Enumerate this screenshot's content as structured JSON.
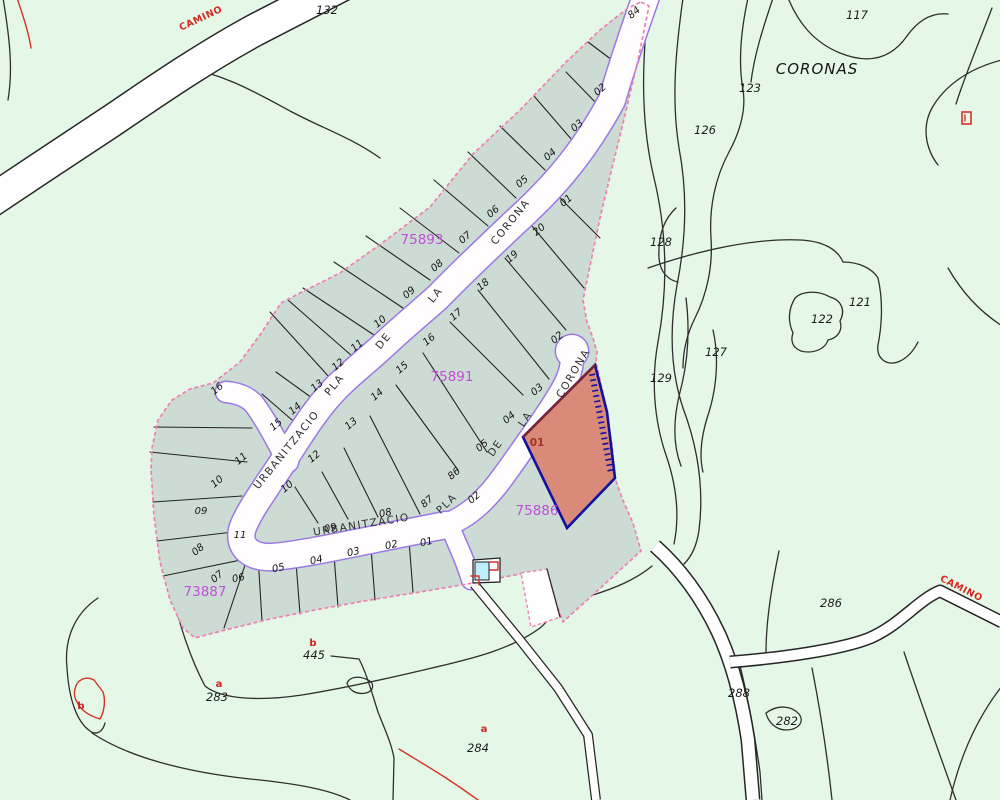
{
  "title": "Cadastral map - Urbanitzacio Pla de la Corona",
  "region_name": "CORONAS",
  "highlighted_plot": {
    "number": "01",
    "parcel_id": "75886"
  },
  "parcel_ids": [
    "75893",
    "75891",
    "75886",
    "73887"
  ],
  "colors": {
    "background": "#e5f7e6",
    "urbanization_fill": "#ccdbd3",
    "road_fill": "#fffdfd",
    "road_border": "#9a79e6",
    "boundary_dash": "#f07fb4",
    "contour": "#2e2e2e",
    "highlight_fill": "#d98a79",
    "highlight_border": "#10129e",
    "highlight_top_edge": "#7c2230",
    "magenta_label": "#c24fd8",
    "red_label": "#cf2020"
  },
  "labels": [
    {
      "t": "CAMINO",
      "x": 202,
      "y": 21,
      "r": -25,
      "c": "camino",
      "n": "road-name-camino-topleft"
    },
    {
      "t": "CAMINO",
      "x": 960,
      "y": 591,
      "r": 27,
      "c": "camino",
      "n": "road-name-camino-right"
    },
    {
      "t": "CORONAS",
      "x": 817,
      "y": 74,
      "r": 0,
      "c": "coronas",
      "n": "region-name-coronas"
    },
    {
      "t": "132",
      "x": 327,
      "y": 14,
      "r": 0,
      "c": "tn",
      "n": "terrain-number"
    },
    {
      "t": "117",
      "x": 857,
      "y": 19,
      "r": 0,
      "c": "tn",
      "n": "terrain-number"
    },
    {
      "t": "123",
      "x": 750,
      "y": 92,
      "r": 0,
      "c": "tn",
      "n": "terrain-number"
    },
    {
      "t": "126",
      "x": 705,
      "y": 134,
      "r": 0,
      "c": "tn",
      "n": "terrain-number"
    },
    {
      "t": "128",
      "x": 661,
      "y": 246,
      "r": 0,
      "c": "tn",
      "n": "terrain-number"
    },
    {
      "t": "121",
      "x": 860,
      "y": 306,
      "r": 0,
      "c": "tn",
      "n": "terrain-number"
    },
    {
      "t": "122",
      "x": 822,
      "y": 323,
      "r": 0,
      "c": "tn",
      "n": "terrain-number"
    },
    {
      "t": "127",
      "x": 716,
      "y": 356,
      "r": 0,
      "c": "tn",
      "n": "terrain-number"
    },
    {
      "t": "129",
      "x": 661,
      "y": 382,
      "r": 0,
      "c": "tn",
      "n": "terrain-number"
    },
    {
      "t": "286",
      "x": 831,
      "y": 607,
      "r": 0,
      "c": "tn",
      "n": "terrain-number"
    },
    {
      "t": "288",
      "x": 739,
      "y": 697,
      "r": 0,
      "c": "tn",
      "n": "terrain-number"
    },
    {
      "t": "282",
      "x": 787,
      "y": 725,
      "r": 0,
      "c": "tn",
      "n": "terrain-number"
    },
    {
      "t": "445",
      "x": 314,
      "y": 659,
      "r": 0,
      "c": "tn",
      "n": "terrain-number"
    },
    {
      "t": "283",
      "x": 217,
      "y": 701,
      "r": 0,
      "c": "tn",
      "n": "terrain-number"
    },
    {
      "t": "284",
      "x": 478,
      "y": 752,
      "r": 0,
      "c": "tn",
      "n": "terrain-number"
    },
    {
      "t": "75893",
      "x": 422,
      "y": 244,
      "r": 0,
      "c": "mg",
      "n": "parcel-id-75893"
    },
    {
      "t": "75891",
      "x": 452,
      "y": 381,
      "r": 0,
      "c": "mg",
      "n": "parcel-id-75891"
    },
    {
      "t": "75886",
      "x": 537,
      "y": 515,
      "r": 0,
      "c": "mg",
      "n": "parcel-id-75886"
    },
    {
      "t": "73887",
      "x": 205,
      "y": 596,
      "r": 0,
      "c": "mg",
      "n": "parcel-id-73887"
    },
    {
      "t": "84",
      "x": 636,
      "y": 15,
      "r": -40,
      "c": "pn",
      "n": "plot-number-84"
    },
    {
      "t": "02",
      "x": 602,
      "y": 92,
      "r": -40,
      "c": "pn",
      "n": "plot-number"
    },
    {
      "t": "03",
      "x": 579,
      "y": 128,
      "r": -40,
      "c": "pn",
      "n": "plot-number"
    },
    {
      "t": "04",
      "x": 552,
      "y": 157,
      "r": -40,
      "c": "pn",
      "n": "plot-number"
    },
    {
      "t": "05",
      "x": 524,
      "y": 184,
      "r": -40,
      "c": "pn",
      "n": "plot-number"
    },
    {
      "t": "06",
      "x": 495,
      "y": 214,
      "r": -40,
      "c": "pn",
      "n": "plot-number"
    },
    {
      "t": "07",
      "x": 467,
      "y": 240,
      "r": -40,
      "c": "pn",
      "n": "plot-number"
    },
    {
      "t": "08",
      "x": 439,
      "y": 268,
      "r": -40,
      "c": "pn",
      "n": "plot-number"
    },
    {
      "t": "09",
      "x": 411,
      "y": 295,
      "r": -40,
      "c": "pn",
      "n": "plot-number"
    },
    {
      "t": "10",
      "x": 382,
      "y": 324,
      "r": -40,
      "c": "pn",
      "n": "plot-number"
    },
    {
      "t": "11",
      "x": 359,
      "y": 348,
      "r": -40,
      "c": "pn",
      "n": "plot-number"
    },
    {
      "t": "12",
      "x": 340,
      "y": 367,
      "r": -40,
      "c": "pn",
      "n": "plot-number"
    },
    {
      "t": "13",
      "x": 319,
      "y": 388,
      "r": -40,
      "c": "pn",
      "n": "plot-number"
    },
    {
      "t": "14",
      "x": 297,
      "y": 411,
      "r": -40,
      "c": "pn",
      "n": "plot-number"
    },
    {
      "t": "15",
      "x": 278,
      "y": 427,
      "r": -40,
      "c": "pn",
      "n": "plot-number"
    },
    {
      "t": "16",
      "x": 219,
      "y": 391,
      "r": -40,
      "c": "pn",
      "n": "plot-number"
    },
    {
      "t": "01",
      "x": 568,
      "y": 203,
      "r": -40,
      "c": "pn",
      "n": "plot-number"
    },
    {
      "t": "20",
      "x": 541,
      "y": 232,
      "r": -40,
      "c": "pn",
      "n": "plot-number"
    },
    {
      "t": "19",
      "x": 514,
      "y": 259,
      "r": -40,
      "c": "pn",
      "n": "plot-number"
    },
    {
      "t": "18",
      "x": 485,
      "y": 287,
      "r": -40,
      "c": "pn",
      "n": "plot-number"
    },
    {
      "t": "17",
      "x": 458,
      "y": 317,
      "r": -40,
      "c": "pn",
      "n": "plot-number"
    },
    {
      "t": "16",
      "x": 431,
      "y": 342,
      "r": -40,
      "c": "pn",
      "n": "plot-number"
    },
    {
      "t": "15",
      "x": 404,
      "y": 370,
      "r": -40,
      "c": "pn",
      "n": "plot-number"
    },
    {
      "t": "14",
      "x": 379,
      "y": 397,
      "r": -40,
      "c": "pn",
      "n": "plot-number"
    },
    {
      "t": "13",
      "x": 353,
      "y": 426,
      "r": -40,
      "c": "pn",
      "n": "plot-number"
    },
    {
      "t": "12",
      "x": 316,
      "y": 459,
      "r": -40,
      "c": "pn",
      "n": "plot-number"
    },
    {
      "t": "10",
      "x": 289,
      "y": 489,
      "r": -40,
      "c": "pn",
      "n": "plot-number"
    },
    {
      "t": "03",
      "x": 539,
      "y": 392,
      "r": -40,
      "c": "pn",
      "n": "plot-number"
    },
    {
      "t": "04",
      "x": 511,
      "y": 420,
      "r": -40,
      "c": "pn",
      "n": "plot-number"
    },
    {
      "t": "05",
      "x": 484,
      "y": 448,
      "r": -40,
      "c": "pn",
      "n": "plot-number"
    },
    {
      "t": "86",
      "x": 456,
      "y": 476,
      "r": -40,
      "c": "pn",
      "n": "plot-number-86"
    },
    {
      "t": "87",
      "x": 429,
      "y": 504,
      "r": -40,
      "c": "pn",
      "n": "plot-number-87"
    },
    {
      "t": "08",
      "x": 386,
      "y": 516,
      "r": -12,
      "c": "pn",
      "n": "plot-number"
    },
    {
      "t": "09",
      "x": 331,
      "y": 531,
      "r": -12,
      "c": "pn",
      "n": "plot-number"
    },
    {
      "t": "02",
      "x": 476,
      "y": 500,
      "r": -40,
      "c": "pn",
      "n": "plot-number"
    },
    {
      "t": "02",
      "x": 559,
      "y": 340,
      "r": -40,
      "c": "pn",
      "n": "plot-number"
    },
    {
      "t": "11",
      "x": 243,
      "y": 461,
      "r": -40,
      "c": "pn",
      "n": "plot-number"
    },
    {
      "t": "10",
      "x": 219,
      "y": 484,
      "r": -40,
      "c": "pn",
      "n": "plot-number"
    },
    {
      "t": "09",
      "x": 201,
      "y": 514,
      "r": 0,
      "c": "pn",
      "n": "plot-number"
    },
    {
      "t": "08",
      "x": 200,
      "y": 552,
      "r": -40,
      "c": "pn",
      "n": "plot-number"
    },
    {
      "t": "07",
      "x": 219,
      "y": 579,
      "r": -40,
      "c": "pn",
      "n": "plot-number"
    },
    {
      "t": "11",
      "x": 240,
      "y": 538,
      "r": 0,
      "c": "pn",
      "n": "plot-number"
    },
    {
      "t": "06",
      "x": 239,
      "y": 581,
      "r": -12,
      "c": "pn",
      "n": "plot-number"
    },
    {
      "t": "05",
      "x": 279,
      "y": 571,
      "r": -12,
      "c": "pn",
      "n": "plot-number"
    },
    {
      "t": "04",
      "x": 317,
      "y": 563,
      "r": -12,
      "c": "pn",
      "n": "plot-number"
    },
    {
      "t": "03",
      "x": 354,
      "y": 555,
      "r": -12,
      "c": "pn",
      "n": "plot-number"
    },
    {
      "t": "02",
      "x": 392,
      "y": 548,
      "r": -12,
      "c": "pn",
      "n": "plot-number"
    },
    {
      "t": "01",
      "x": 427,
      "y": 545,
      "r": -12,
      "c": "pn",
      "n": "plot-number"
    },
    {
      "t": "01",
      "x": 537,
      "y": 446,
      "r": 0,
      "c": "p01",
      "n": "highlighted-plot-number"
    },
    {
      "t": "URBANITZACIO",
      "x": 289,
      "y": 452,
      "r": -51,
      "c": "rw",
      "n": "road-name-urbanitzacio-upper"
    },
    {
      "t": "PLA",
      "x": 337,
      "y": 387,
      "r": -51,
      "c": "rw",
      "n": "road-word-pla"
    },
    {
      "t": "DE",
      "x": 386,
      "y": 343,
      "r": -51,
      "c": "rw",
      "n": "road-word-de"
    },
    {
      "t": "LA",
      "x": 438,
      "y": 297,
      "r": -51,
      "c": "rw",
      "n": "road-word-la"
    },
    {
      "t": "CORONA",
      "x": 513,
      "y": 224,
      "r": -51,
      "c": "rw",
      "n": "road-word-corona"
    },
    {
      "t": "URBANITZACIO",
      "x": 362,
      "y": 528,
      "r": -9,
      "c": "rw",
      "n": "road-name-urbanitzacio-lower"
    },
    {
      "t": "PLA",
      "x": 449,
      "y": 506,
      "r": -44,
      "c": "rw",
      "n": "road-word-pla"
    },
    {
      "t": "DE",
      "x": 498,
      "y": 450,
      "r": -55,
      "c": "rw",
      "n": "road-word-de"
    },
    {
      "t": "LA",
      "x": 528,
      "y": 421,
      "r": -55,
      "c": "rw",
      "n": "road-word-la"
    },
    {
      "t": "CORONA",
      "x": 576,
      "y": 375,
      "r": -59,
      "c": "rw",
      "n": "road-word-corona"
    },
    {
      "t": "a",
      "x": 219,
      "y": 687,
      "r": 0,
      "c": "rd",
      "n": "sub-parcel-a"
    },
    {
      "t": "b",
      "x": 313,
      "y": 646,
      "r": 0,
      "c": "rd",
      "n": "sub-parcel-b"
    },
    {
      "t": "b",
      "x": 81,
      "y": 709,
      "r": 0,
      "c": "rd",
      "n": "sub-parcel-b"
    },
    {
      "t": "a",
      "x": 484,
      "y": 732,
      "r": 0,
      "c": "rd",
      "n": "sub-parcel-a"
    }
  ]
}
